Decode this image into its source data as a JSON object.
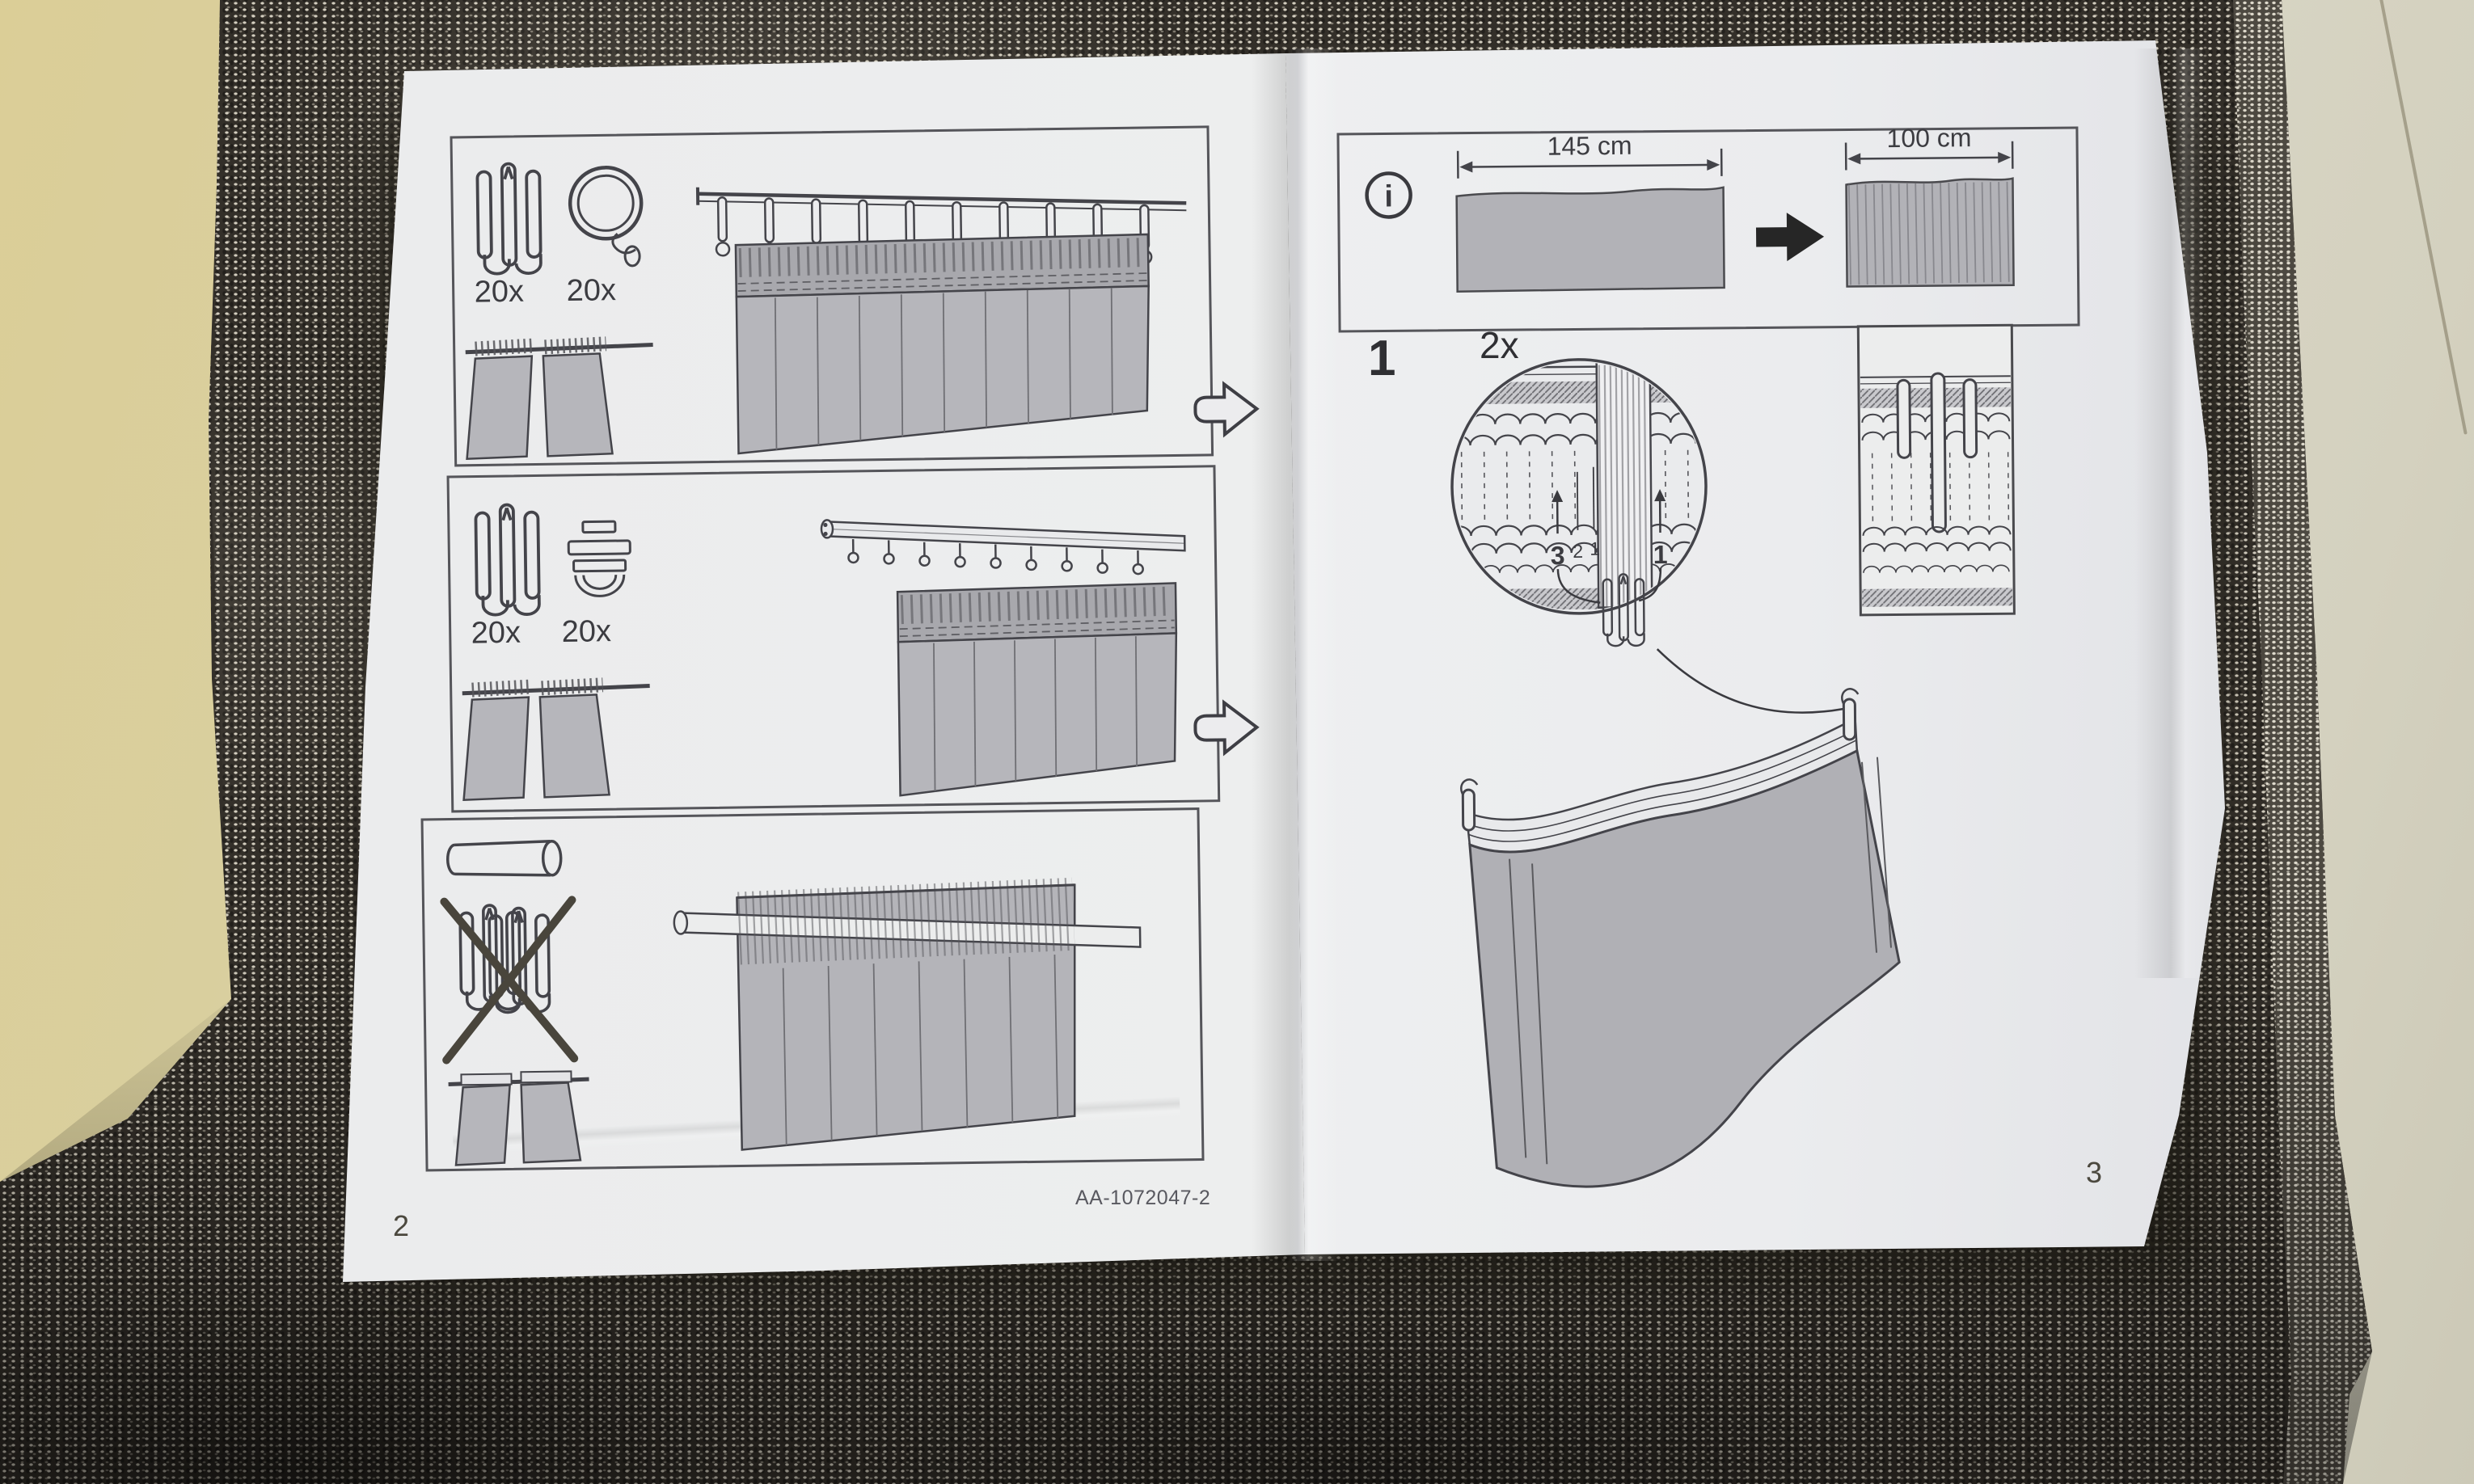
{
  "photo": {
    "subject": "curtain assembly instruction booklet photographed lying on folded dark speckled curtain fabric on a table"
  },
  "colors": {
    "table": "#dbce97",
    "table_right": "#d9d6c5",
    "fabric": "#332f29",
    "fabric_speckle": "#d8d2c4",
    "paper": "#e9eaec",
    "diagram_fill": "#b4b4b9",
    "line": "#44444a",
    "solid_arrow": "#262626",
    "text": "#3c3c41"
  },
  "left_page": {
    "page_number": "2",
    "panel_rings": {
      "hook_qty": "20x",
      "ring_qty": "20x",
      "icons": [
        "pleat-hook-icon",
        "curtain-ring-clip-icon"
      ],
      "shows": "two curtain panels hung with pleat hooks and clip rings on a curtain rod"
    },
    "panel_gliders": {
      "hook_qty": "20x",
      "glider_qty": "20x",
      "icons": [
        "pleat-hook-icon",
        "track-glider-icon"
      ],
      "shows": "two curtain panels hung with pleat hooks and gliders on a curtain track"
    },
    "panel_rod_pocket": {
      "icons": [
        "curtain-rod-icon",
        "no-pleat-hook-icon"
      ],
      "shows": "curtain hung directly on a rod through the heading channel, pleat hooks crossed out"
    }
  },
  "right_page": {
    "page_number": "3",
    "info_box": {
      "icon": "info-icon",
      "flat_width_label": "145 cm",
      "pleated_width_label": "100 cm"
    },
    "step1": {
      "number": "1",
      "repeat_label": "2x",
      "pocket_labels": {
        "left_bold": "3",
        "left_mid": "2",
        "left_inner": "1",
        "right_bold": "1"
      }
    }
  },
  "footer": {
    "doc_code": "AA-1072047-2"
  }
}
